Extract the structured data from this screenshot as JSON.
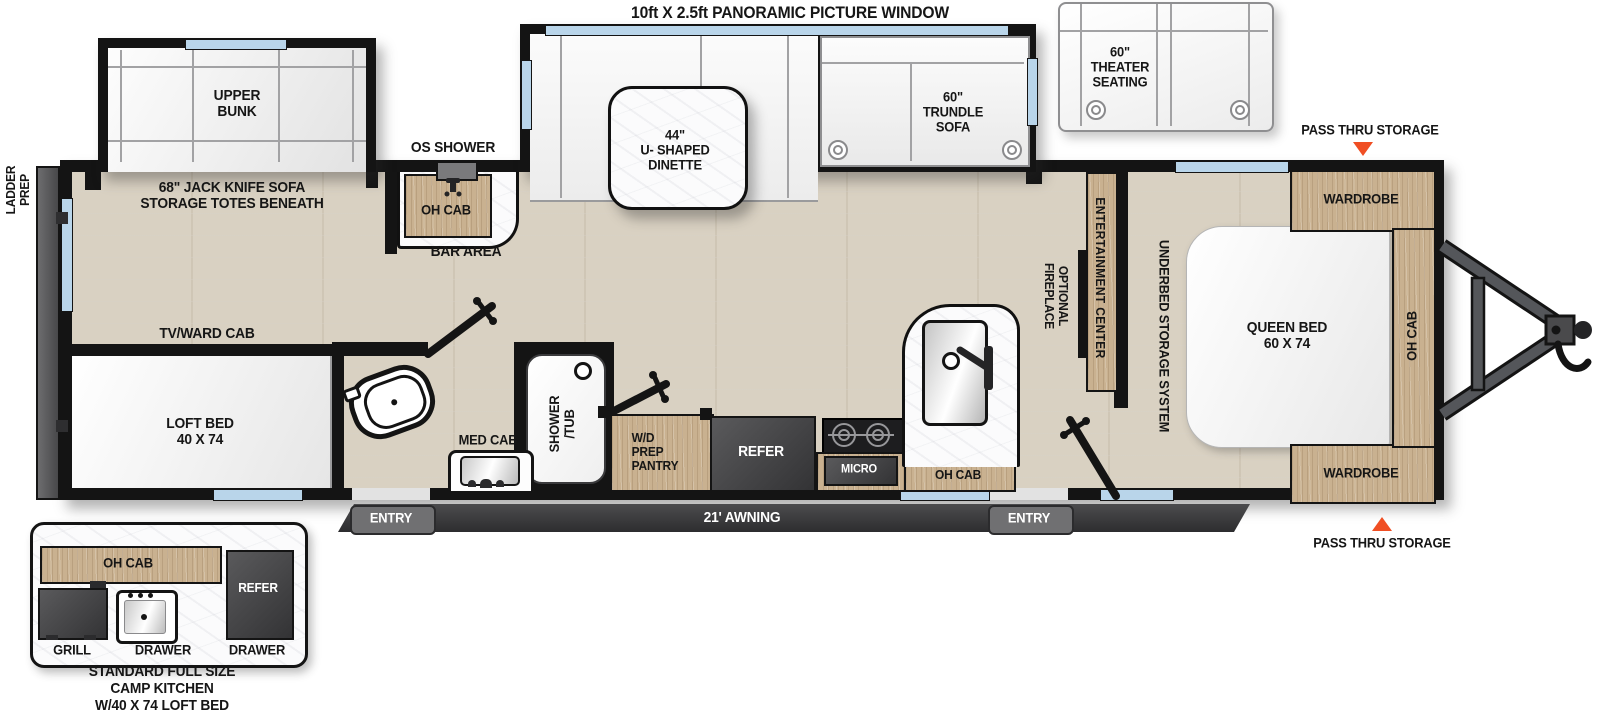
{
  "labels": {
    "title": "10ft X 2.5ft PANORAMIC PICTURE WINDOW",
    "upper_bunk": "UPPER\nBUNK",
    "jack_knife_sofa": "68\" JACK KNIFE SOFA\nSTORAGE TOTES BENEATH",
    "os_shower": "OS SHOWER",
    "bar_oh_cab": "OH CAB",
    "bar_area": "BAR AREA",
    "dinette": "44\"\nU- SHAPED\nDINETTE",
    "trundle_sofa": "60\"\nTRUNDLE\nSOFA",
    "theater_seating": "60\"\nTHEATER\nSEATING",
    "pass_thru_top": "PASS THRU STORAGE",
    "pass_thru_bottom": "PASS THRU STORAGE",
    "ladder_prep": "LADDER\nPREP",
    "entertainment_center": "ENTERTAINMENT CENTER",
    "optional_fireplace": "OPTIONAL\nFIREPLACE",
    "underbed_storage": "UNDERBED STORAGE SYSTEM",
    "queen_bed": "QUEEN BED\n60 X 74",
    "wardrobe_top": "WARDROBE",
    "wardrobe_bottom": "WARDROBE",
    "bedroom_oh_cab": "OH CAB",
    "tv_ward_cab": "TV/WARD CAB",
    "loft_bed": "LOFT BED\n40 X 74",
    "med_cab": "MED CAB",
    "shower_tub": "SHOWER\n/TUB",
    "wd_prep_pantry": "W/D\nPREP\nPANTRY",
    "refer": "REFER",
    "micro": "MICRO",
    "kitchen_oh_cab": "OH CAB",
    "entry_left": "ENTRY",
    "entry_right": "ENTRY",
    "awning": "21' AWNING"
  },
  "camp_kitchen": {
    "oh_cab": "OH CAB",
    "refer": "REFER",
    "grill": "GRILL",
    "drawer_1": "DRAWER",
    "drawer_2": "DRAWER",
    "caption": "STANDARD FULL SIZE\nCAMP KITCHEN\nW/40 X 74 LOFT BED"
  },
  "colors": {
    "wall": "#141414",
    "floor_wood": "#d9d1c2",
    "cabinet_wood": "#c9b190",
    "window_blue": "#b9d5ea",
    "accent_triangle": "#f04e23",
    "appliance_gray": "#464648",
    "awning_bar": "#3b3b3d"
  }
}
